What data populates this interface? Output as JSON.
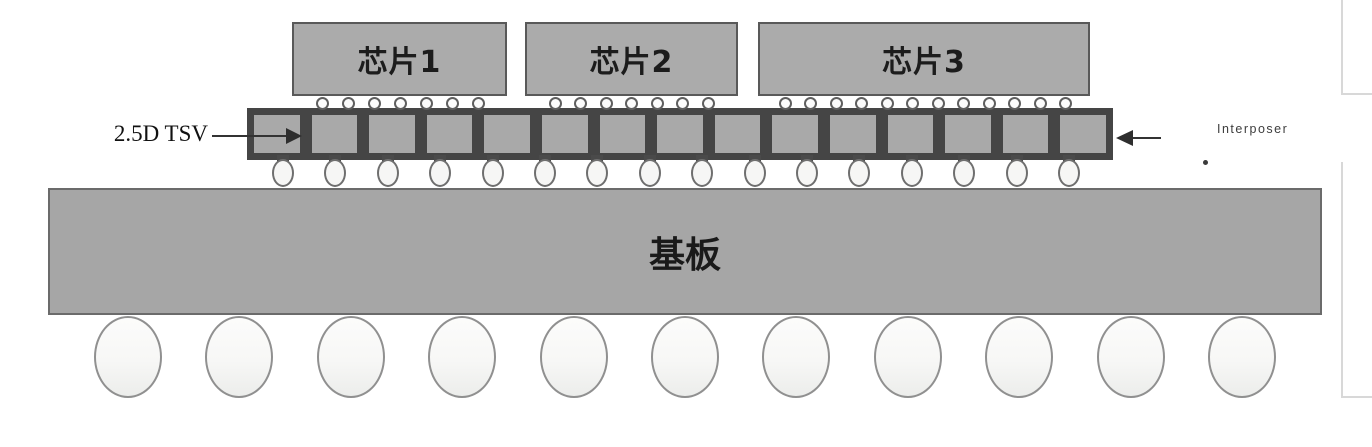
{
  "figure": {
    "title_semantics": "2.5D TSV interposer package cross-section diagram",
    "chips": [
      {
        "label": "芯片1"
      },
      {
        "label": "芯片2"
      },
      {
        "label": "芯片3"
      }
    ],
    "tsv_callout_label": "2.5D TSV",
    "interposer_callout_label": "Interposer",
    "substrate_label": "基板",
    "structure": {
      "tsv_cell_count": 15,
      "chip_microbump_counts": [
        7,
        7,
        12
      ],
      "c4_bump_count": 16,
      "bga_ball_count": 11
    },
    "colors": {
      "chip_fill": "#ababab",
      "chip_border": "#595959",
      "interposer_dark": "#454545",
      "tsv_cell_fill": "#a9a9a9",
      "substrate_fill": "#a6a6a6",
      "substrate_border": "#6b6b6b",
      "bump_fill": "#f9f9f8",
      "bump_stroke": "#6f6f6f",
      "ball_stroke": "#909090",
      "callout_text": "#111111",
      "panel_edge": "#d8d8d8"
    }
  }
}
